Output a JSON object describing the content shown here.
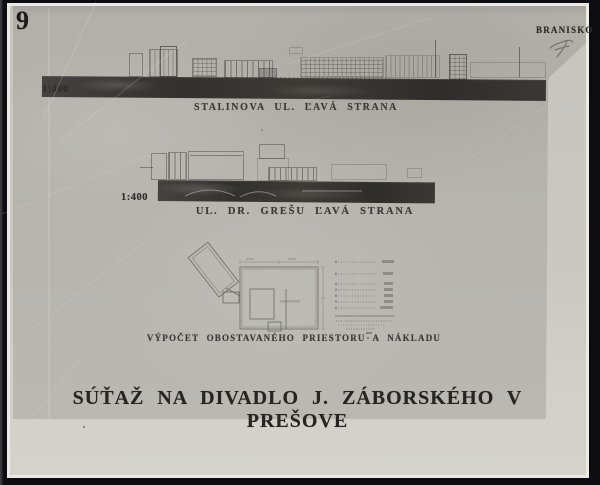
{
  "stamps": {
    "corner_number": "9",
    "competition_motto": "BRANISKO",
    "handwritten_mark": "7"
  },
  "elevations": [
    {
      "scale": "1:400",
      "caption": "STALINOVA UL. ĽAVÁ STRANA"
    },
    {
      "scale": "1:400",
      "caption": "UL. DR. GREŠU ĽAVÁ STRANA"
    }
  ],
  "plan": {
    "caption": "VÝPOČET OBOSTAVANÉHO PRIESTORU A NÁKLADU"
  },
  "title": "SÚŤAŽ NA DIVADLO J. ZÁBORSKÉHO V PREŠOVE",
  "colors": {
    "background": "#0d0d0f",
    "photo_paper": "#cbc8c2",
    "sheet": "#b6b3ad",
    "elevation_band": "#383531",
    "ink": "#2a2825"
  }
}
